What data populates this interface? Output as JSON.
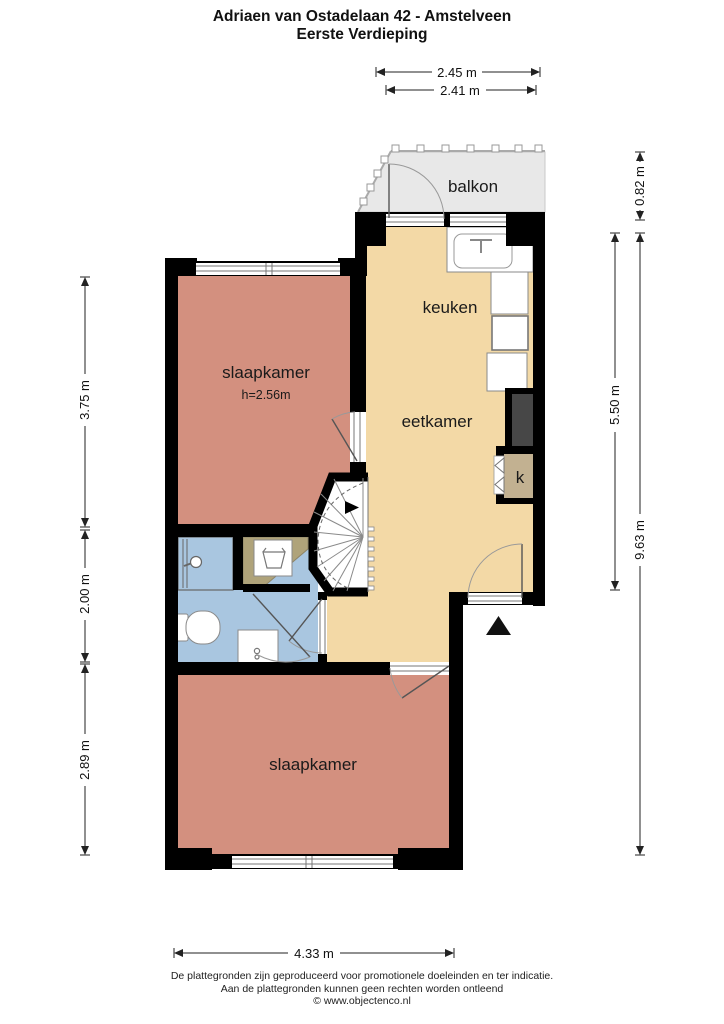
{
  "title": {
    "line1": "Adriaen van Ostadelaan 42 - Amstelveen",
    "line2": "Eerste Verdieping"
  },
  "rooms": {
    "balcony": "balkon",
    "kitchen": "keuken",
    "dining": "eetkamer",
    "bedroom_top": "slaapkamer",
    "bedroom_top_height": "h=2.56m",
    "bedroom_bottom": "slaapkamer",
    "closet": "k"
  },
  "dimensions": {
    "top_outer": "2.45 m",
    "top_inner": "2.41 m",
    "right_balcony": "0.82 m",
    "right_upper": "5.50 m",
    "right_total": "9.63 m",
    "left_upper": "3.75 m",
    "left_middle": "2.00 m",
    "left_lower": "2.89 m",
    "bottom": "4.33 m"
  },
  "footer": {
    "line1": "De plattegronden zijn geproduceerd voor promotionele doeleinden en ter indicatie.",
    "line2": "Aan de plattegronden kunnen geen rechten worden ontleend",
    "line3": "© www.objectenco.nl"
  },
  "colors": {
    "wall": "#000000",
    "bedroom": "#d3907f",
    "living": "#f3d9a6",
    "bathroom": "#a9c6e0",
    "balcony": "#e8e8e8",
    "closet": "#c2b191",
    "laundry_niche": "#afa37a",
    "shaft": "#474747",
    "stairs": "#ffffff"
  }
}
